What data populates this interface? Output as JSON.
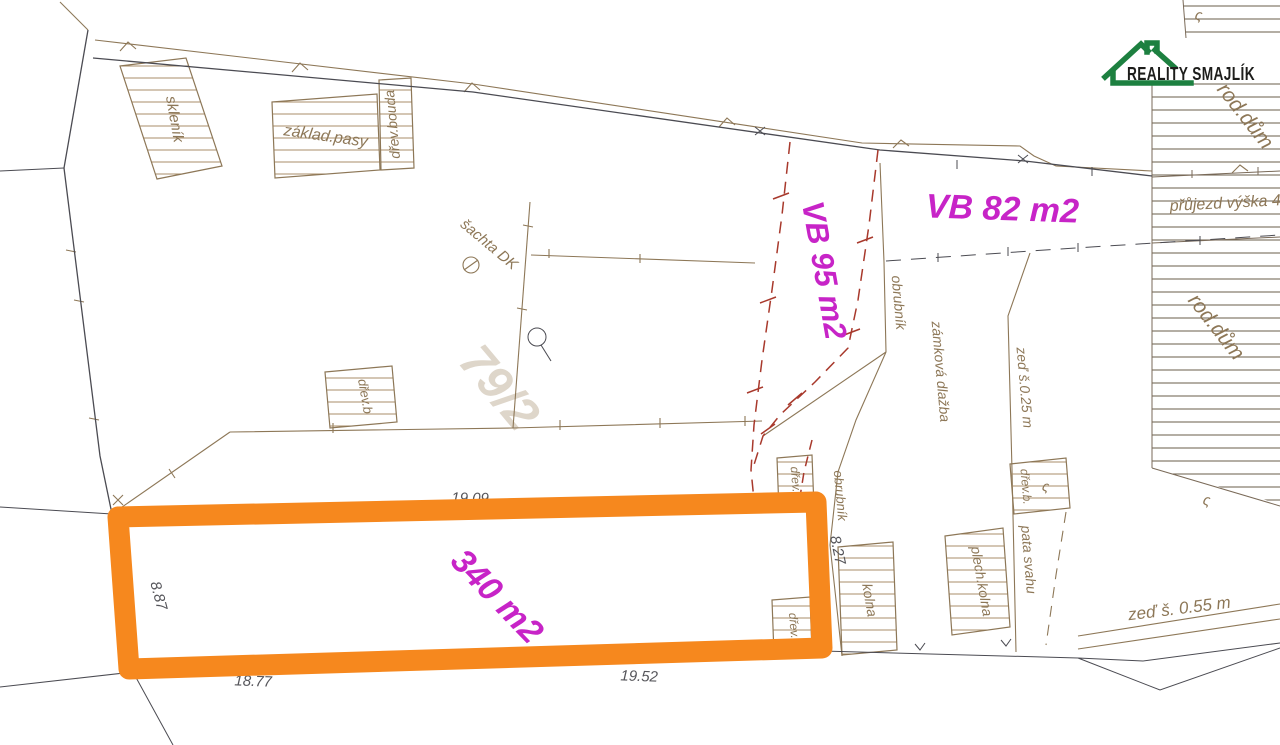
{
  "page": {
    "width": 1280,
    "height": 745,
    "background": "#ffffff"
  },
  "logo": {
    "brand": "REALITY SMAJLÍK",
    "green": "#1d8040",
    "ink": "#1d1d1b"
  },
  "highlight": {
    "label": "340 m2",
    "color": "#f6881e",
    "dim_left": "8.87",
    "dim_bottom_left": "18.77",
    "dim_bottom_right": "19.52",
    "dim_top": "19.09",
    "dim_right": "8.27"
  },
  "easements": {
    "vb95": "VB 95 m2",
    "vb82": "VB 82 m2",
    "color": "#c724c7",
    "dash_color": "#a8392c"
  },
  "parcel": {
    "number": "79/2"
  },
  "structures": {
    "sklenik": "skleník",
    "zaklad_pasy": "základ.pasy",
    "drev_bouda": "dřev.bouda",
    "drev_b_mid": "dřev.b",
    "drev_b_right": "dřev.b",
    "drev_bottom": "dřev.",
    "kolna": "kolna",
    "plech_kolna": "plech.kolna",
    "drev_b_s": "dřev.b.",
    "rod_dum": "rod.dům",
    "rod_dum_top": "rod.dům"
  },
  "features": {
    "sachta": "šachta DK",
    "obrubnik1": "obrubník",
    "obrubnik2": "obrubník",
    "zamkova_dlazba": "zámková dlažba",
    "zed_025": "zeď š.0.25 m",
    "zed_055": "zeď š. 0.55 m",
    "pata_svahu": "pata svahu",
    "prujezd": "přůjezd výška 4.",
    "s_mark": "ς"
  },
  "colors": {
    "tan": "#8d7757",
    "hatch": "#a98e68",
    "dark": "#4b4b52",
    "dim": "#55555a",
    "watermark": "#ded6ca"
  }
}
